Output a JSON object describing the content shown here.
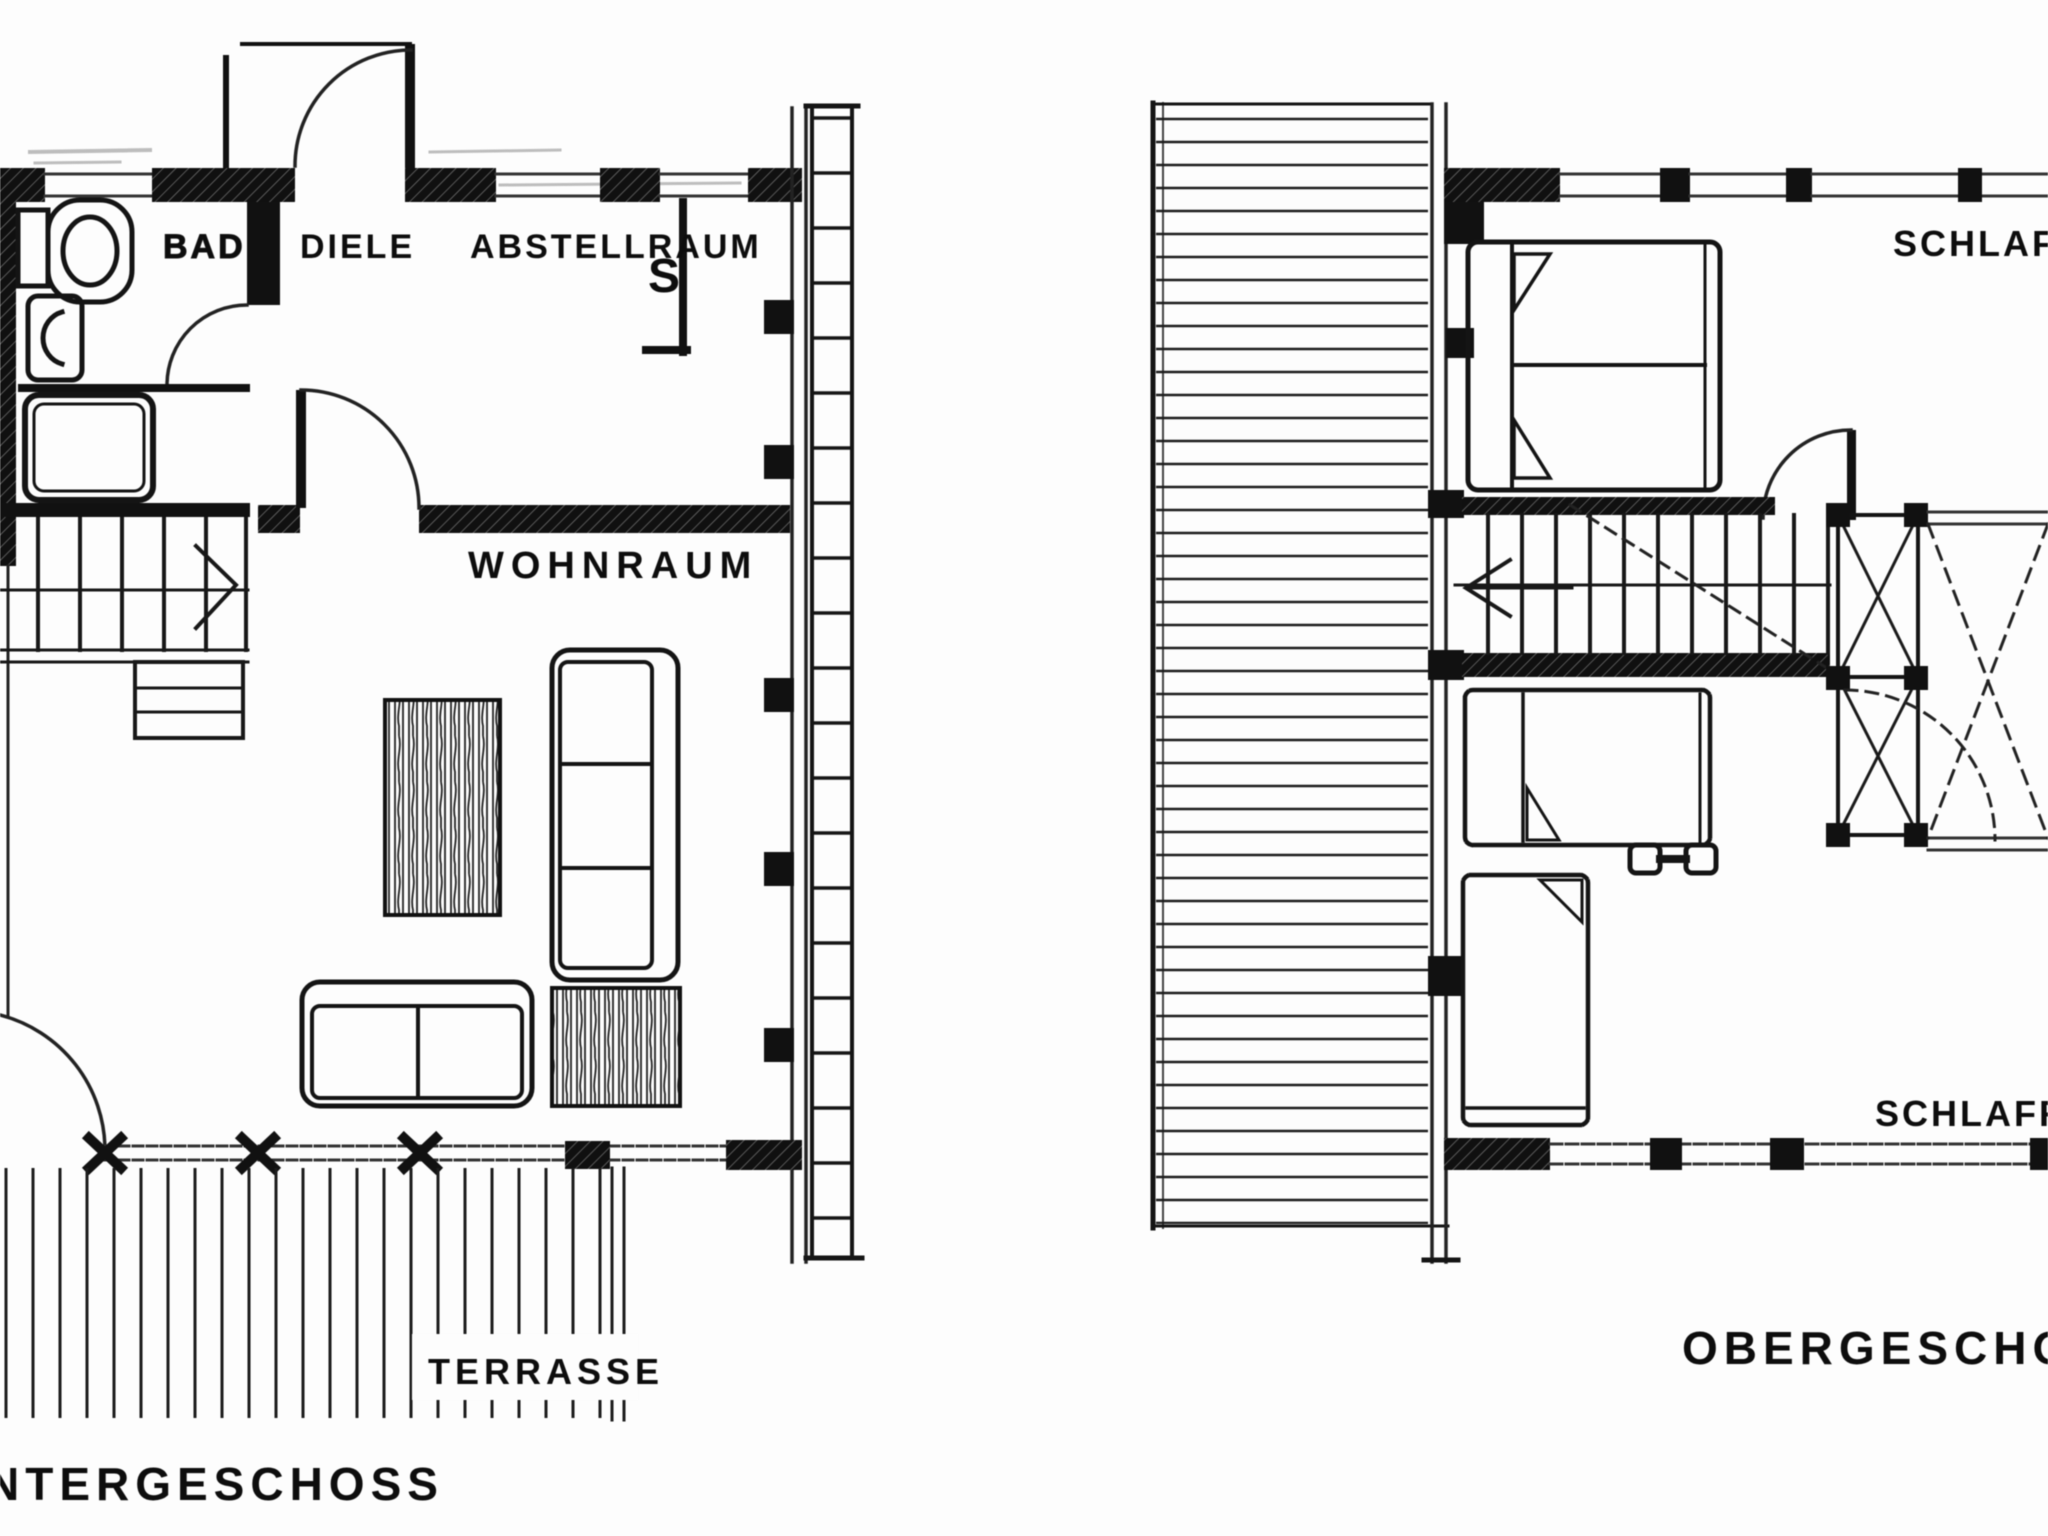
{
  "plans": {
    "lower": {
      "caption": "NTERGESCHOSS",
      "rooms": {
        "bad": "BAD",
        "diele": "DIELE",
        "abstellraum": "ABSTELLRAUM",
        "wohnraum": "WOHNRAUM",
        "terrasse": "TERRASSE"
      },
      "symbols": {
        "flue": "S"
      }
    },
    "upper": {
      "caption": "OBERGESCHOSS",
      "rooms": {
        "schlafraum_top": "SCHLAFR",
        "schlafraum_bottom": "SCHLAFR"
      }
    }
  },
  "colors": {
    "ink": "#0d0d0d",
    "paper": "#fdfdfd"
  }
}
